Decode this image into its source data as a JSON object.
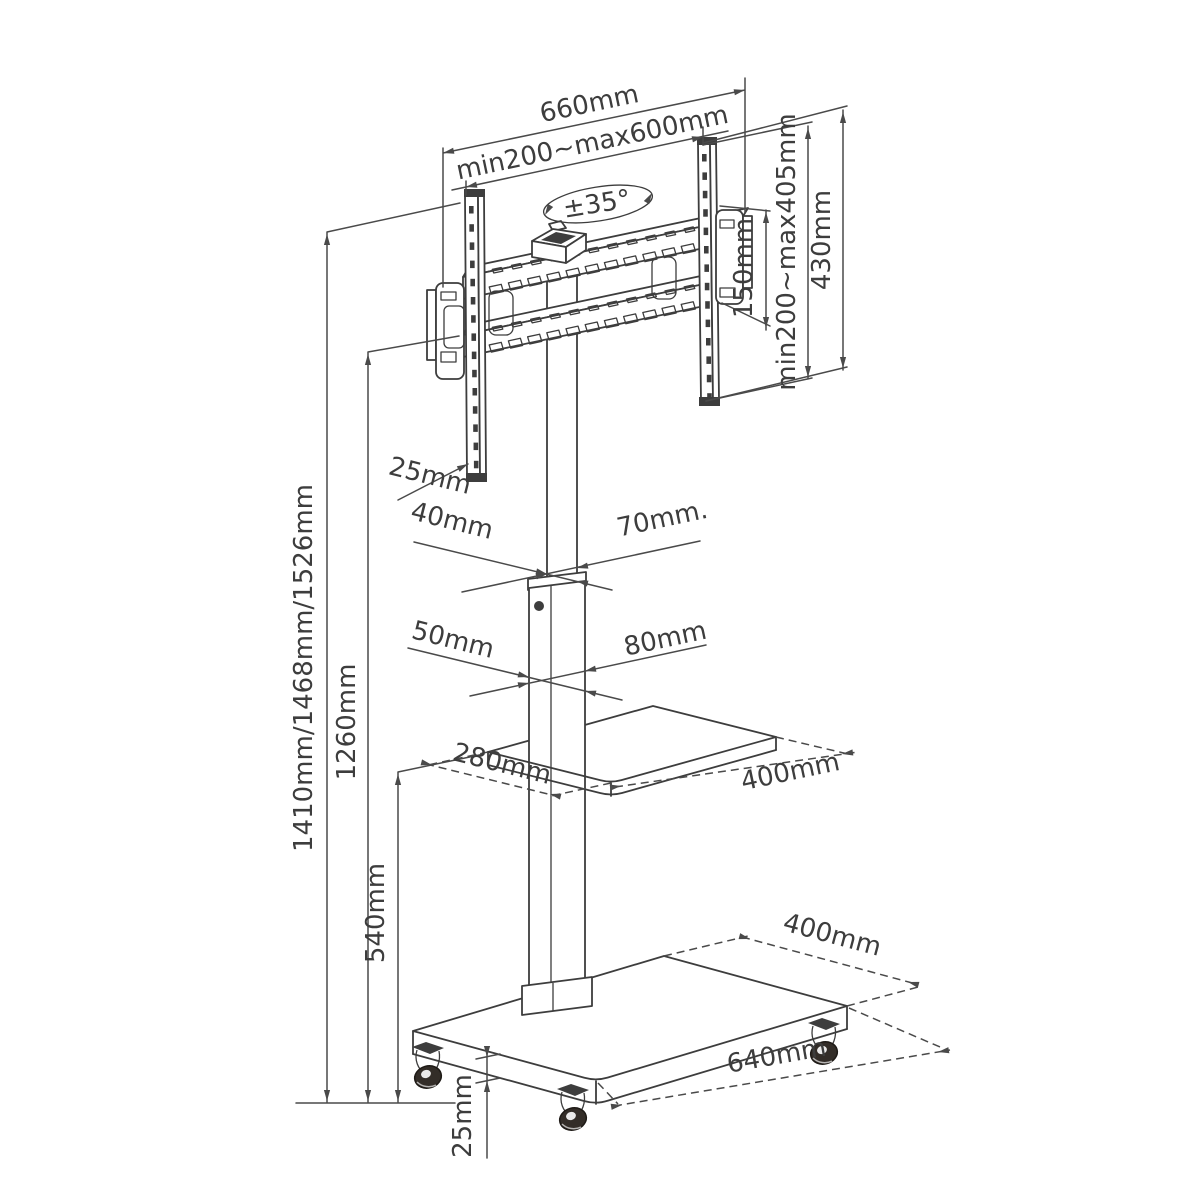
{
  "drawing": {
    "type": "technical-dimension-diagram",
    "subject": "Mobile TV floor stand with swivel bracket, media shelf and casters",
    "background": "#ffffff",
    "line_color": "#3d3d3d",
    "text_color": "#3d3d3d"
  },
  "labels": {
    "bracket_width": "660mm",
    "vesa_width_range": "min200~max600mm",
    "swivel_angle": "±35°",
    "adapter_plate_height": "150mm",
    "vesa_height_range": "min200~max405mm",
    "bracket_height": "430mm",
    "bracket_depth": "25mm",
    "upper_column_depth": "40mm",
    "upper_column_width": "70mm.",
    "lower_column_depth": "50mm",
    "lower_column_width": "80mm",
    "shelf_depth": "280mm",
    "shelf_width": "400mm",
    "overall_heights": "1410mm/1468mm/1526mm",
    "column_height": "1260mm",
    "shelf_height": "540mm",
    "base_depth": "400mm",
    "base_width": "640mm",
    "base_edge_thickness": "25mm"
  }
}
